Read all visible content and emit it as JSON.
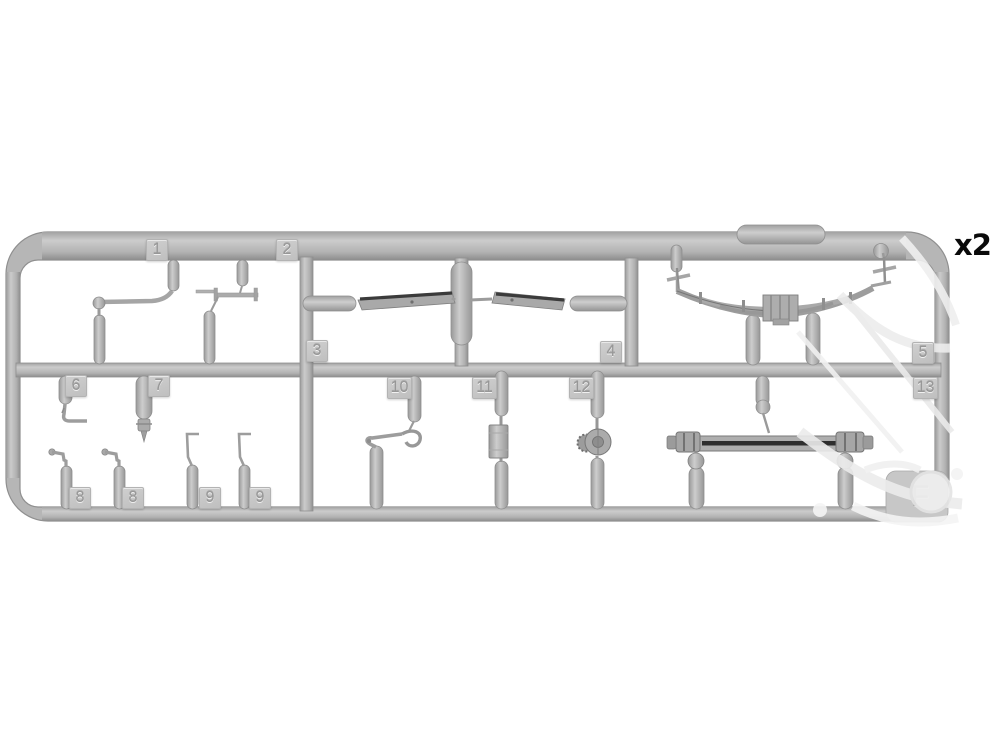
{
  "page": {
    "background_color": "#ffffff",
    "plastic_color": "#b6b6b6",
    "plastic_highlight": "#d2d2d2",
    "plastic_shadow": "#8d8d8d",
    "tag_plate_color": "#c7c7c7",
    "tag_text_color": "#979797",
    "watermark_color": "#ededed"
  },
  "quantity_label": "x2",
  "sprue_letter": "F",
  "tags": [
    {
      "label": "1"
    },
    {
      "label": "2"
    },
    {
      "label": "3"
    },
    {
      "label": "4"
    },
    {
      "label": "5"
    },
    {
      "label": "6"
    },
    {
      "label": "7"
    },
    {
      "label": "8"
    },
    {
      "label": "8"
    },
    {
      "label": "9"
    },
    {
      "label": "9"
    },
    {
      "label": "10"
    },
    {
      "label": "11"
    },
    {
      "label": "12"
    },
    {
      "label": "13"
    }
  ]
}
